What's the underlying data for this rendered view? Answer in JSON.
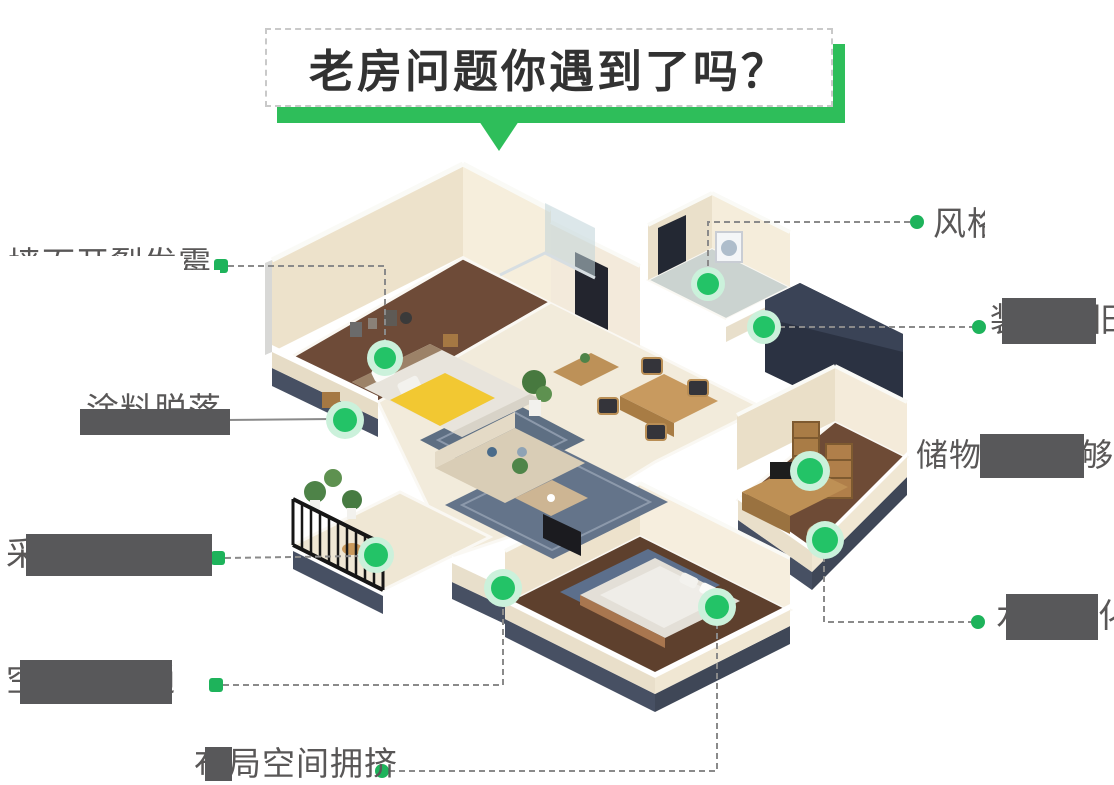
{
  "title": {
    "text": "老房问题你遇到了吗？"
  },
  "problems": [
    {
      "id": "wall-crack-mildew",
      "text": "墙面开裂发霉"
    },
    {
      "id": "paint-peeling",
      "text": "涂料脱落"
    },
    {
      "id": "poor-lighting",
      "text": "采光不足"
    },
    {
      "id": "poor-ventilation",
      "text": "空气不流通"
    },
    {
      "id": "layout-crowded",
      "text": "布局空间拥挤"
    },
    {
      "id": "style-outdated",
      "text": "风格老旧"
    },
    {
      "id": "decor-outdated",
      "text": "装修陈旧"
    },
    {
      "id": "storage-lacking",
      "text": "储物空间不够"
    },
    {
      "id": "utilities-aging",
      "text": "水电老化"
    }
  ],
  "colors": {
    "accent_green": "#2EBE5A",
    "dot_green": "#23C367",
    "dot_halo": "#CBF1DB",
    "label_gray": "#595757",
    "line_gray": "#8A8A8A",
    "mask_dark": "#58585A",
    "mask_white": "#FFFFFF"
  }
}
